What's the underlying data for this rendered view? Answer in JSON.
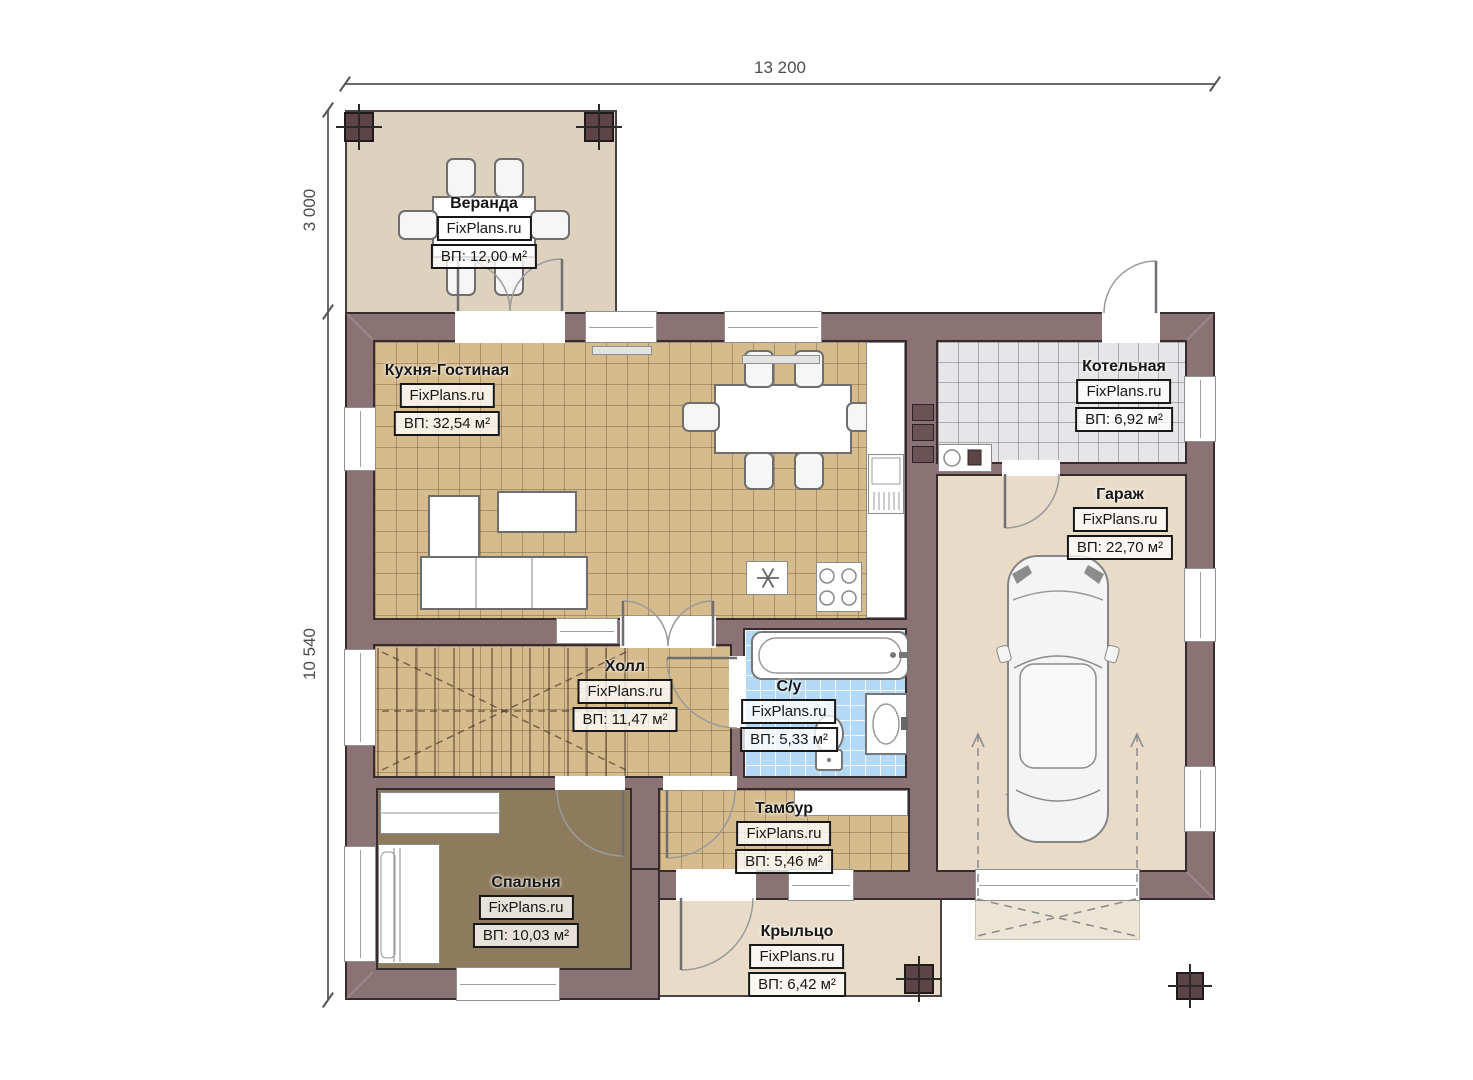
{
  "watermark": "FixPlans.ru",
  "dimensions": {
    "top_width": "13 200",
    "left_upper": "3 000",
    "left_lower": "10 540"
  },
  "rooms": [
    {
      "key": "veranda",
      "name": "Веранда",
      "area": "ВП: 12,00 м²"
    },
    {
      "key": "kitchen-living",
      "name": "Кухня-Гостиная",
      "area": "ВП: 32,54 м²"
    },
    {
      "key": "boiler",
      "name": "Котельная",
      "area": "ВП: 6,92 м²"
    },
    {
      "key": "garage",
      "name": "Гараж",
      "area": "ВП: 22,70 м²"
    },
    {
      "key": "hall",
      "name": "Холл",
      "area": "ВП: 11,47 м²"
    },
    {
      "key": "wc",
      "name": "С/у",
      "area": "ВП: 5,33 м²"
    },
    {
      "key": "tambour",
      "name": "Тамбур",
      "area": "ВП: 5,46 м²"
    },
    {
      "key": "bedroom",
      "name": "Спальня",
      "area": "ВП: 10,03 м²"
    },
    {
      "key": "porch",
      "name": "Крыльцо",
      "area": "ВП: 6,42 м²"
    }
  ],
  "colors": {
    "wall": "#8b7375",
    "wall_outline": "#362b2e",
    "floor_tile_tan": "#d6bb8d",
    "floor_beige": "#e8dcc8",
    "floor_veranda": "#ded2be",
    "floor_boiler": "#e6e6e8",
    "floor_bath": "#b4d9f6",
    "floor_bedroom": "#8e7a5c",
    "column": "#5d4547"
  }
}
